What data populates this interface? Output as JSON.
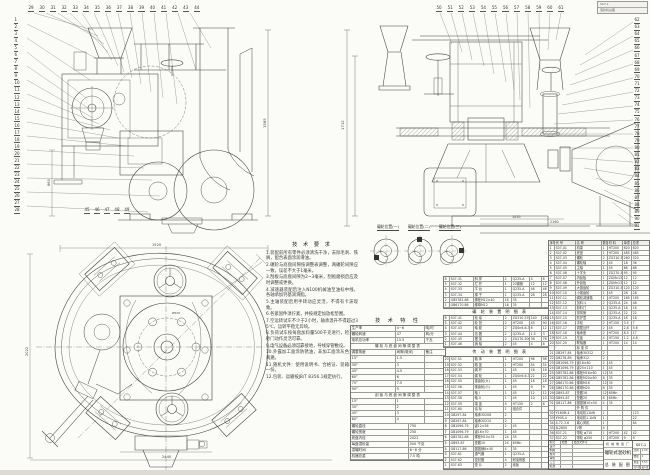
{
  "sheet": {
    "bg": "#fbfbf8",
    "line_color": "#3f3f3f",
    "strip_color": "#dcdbd6"
  },
  "stamp": {
    "line1": "S07-1",
    "line2": "混砂机总图"
  },
  "callouts": {
    "sv_left": [
      "1",
      "2",
      "3",
      "4",
      "5",
      "6",
      "7",
      "8",
      "9",
      "10",
      "11",
      "12",
      "13",
      "14",
      "15",
      "16",
      "17",
      "18",
      "19",
      "20",
      "21",
      "22",
      "23",
      "24",
      "25",
      "26",
      "27",
      "28"
    ],
    "sv_top": [
      "29",
      "30",
      "31",
      "32",
      "33",
      "34",
      "35",
      "36",
      "37",
      "38",
      "39",
      "40",
      "41",
      "42",
      "43",
      "44"
    ],
    "sv_bottom": [
      "45",
      "46",
      "47",
      "48",
      "49"
    ],
    "fv_top": [
      "50",
      "51",
      "52",
      "53",
      "54",
      "55",
      "56",
      "57",
      "58",
      "59",
      "60",
      "61"
    ],
    "fv_right": [
      "62",
      "63",
      "64",
      "65",
      "66",
      "67",
      "68",
      "69",
      "70",
      "71",
      "72",
      "73",
      "74",
      "75",
      "76",
      "77",
      "78",
      "79",
      "80",
      "81",
      "82",
      "83",
      "84",
      "85",
      "86",
      "87",
      "88",
      "89",
      "90",
      "91"
    ]
  },
  "dims": {
    "sv_h": "1585",
    "sv_w": "660",
    "fv_h": "1712",
    "fv_w1": "1035",
    "fv_w2": "2160",
    "pv_top": "1520",
    "pv_left": "2022",
    "pv_bottom": "2440",
    "pv_flange": "Ø520"
  },
  "detail_labels": [
    "碾轮位置(一)",
    "碾轮位置(二)",
    "碾轮位置(三)"
  ],
  "notes": {
    "title": "技 术 要 求",
    "items": [
      "1.装配前所有零件必须清洗干净，去除毛刺、铁屑，配合表面涂润滑油。",
      "2.碾轮与底盘间隙按调整表调整，两碾轮间隙应一致，误差不大于1毫米。",
      "3.刮板与底盘间隙为2~3毫米，刮板磨损后应及时调整或更换。",
      "4.减速器装配后注入N100机械油至油标中线，各轴承加钙基润滑脂。",
      "5.主轴装配后用手转动应灵活，不得有卡滞现象。",
      "6.各紧固件须拧紧，并按规定加放松垫圈。",
      "7.空运转试车不少于2小时，轴承温升不得超过35℃，运转平稳无异响。",
      "8.负荷试车按每盘加料量500千克进行，检查出砂门动作灵活可靠。",
      "9.电气设备必须可靠接地，导线穿管敷设。",
      "10.外露加工面涂防锈油，非加工面涂灰色油漆两遍。",
      "11.随机文件：使用说明书、合格证、装箱单各一份。",
      "12.包装、运输按JB/T 8356.1规定执行。"
    ]
  },
  "spec": {
    "title": "技 术 特 性",
    "top_rows": [
      [
        "生产率",
        "4~6",
        "吨/时"
      ],
      [
        "碾轮转速",
        "47",
        "转/分"
      ],
      [
        "电机总功率",
        "15.5",
        "千瓦"
      ]
    ],
    "h1": "碾轮与底盘间隙调整表",
    "g_head": [
      "调整角度",
      "间隙(毫米)",
      "备注"
    ],
    "g1_rows": [
      [
        "15°",
        "1.5",
        ""
      ],
      [
        "30°",
        "3",
        ""
      ],
      [
        "45°",
        "4.5",
        ""
      ],
      [
        "60°",
        "6",
        ""
      ],
      [
        "75°",
        "7.5",
        ""
      ],
      [
        "90°",
        "9",
        ""
      ]
    ],
    "h2": "刮板与底盘间隙调整表",
    "g2_rows": [
      [
        "15°",
        "1",
        ""
      ],
      [
        "30°",
        "2",
        ""
      ],
      [
        "45°",
        "3",
        ""
      ],
      [
        "60°",
        "4",
        ""
      ]
    ],
    "bottom_rows": [
      [
        "碾轮直径",
        "750"
      ],
      [
        "碾轮宽度",
        "250"
      ],
      [
        "底盘内径",
        "2022"
      ],
      [
        "每盘混砂量",
        "500 千克"
      ],
      [
        "混碾时间",
        "6~8 分"
      ],
      [
        "机器总重",
        "7.5 吨"
      ]
    ]
  },
  "subtables": {
    "a_rows": [
      [
        "6",
        "S07-31",
        "斜 撑",
        "2",
        "Q235-A",
        "4",
        "8"
      ],
      [
        "5",
        "S07-32",
        "栏 杆",
        "1",
        "20钢管",
        "12",
        "12"
      ],
      [
        "4",
        "S07-33",
        "平 台",
        "1",
        "Q235-A",
        "46",
        "46"
      ],
      [
        "3",
        "S07-34",
        "梯 子",
        "1",
        "Q235-A",
        "28",
        "28"
      ],
      [
        "2",
        "GB5782-86",
        "螺栓M12×40",
        "16",
        "35",
        "",
        ""
      ],
      [
        "1",
        "GB6170-86",
        "螺母M12",
        "16",
        "35",
        "",
        ""
      ]
    ],
    "b_title": "碾 轮 装 置 明 细 表",
    "b_rows": [
      [
        "6",
        "S07-41",
        "轮 缘",
        "2",
        "ZG310-570",
        "140",
        "280"
      ],
      [
        "5",
        "S07-42",
        "轮 毂",
        "2",
        "HT200",
        "45",
        "90"
      ],
      [
        "4",
        "S07-43",
        "轴 套",
        "2",
        "ZQSn6-6-3",
        "6",
        "12"
      ],
      [
        "3",
        "S07-44",
        "挡 圈",
        "2",
        "Q235-A",
        "1.5",
        "3"
      ],
      [
        "2",
        "S07-45",
        "摆 架",
        "2",
        "ZG270-500",
        "38",
        "76"
      ],
      [
        "1",
        "S07-46",
        "销 轴",
        "2",
        "45",
        "4",
        "8"
      ]
    ],
    "c_title": "传 动 装 置 明 细 表",
    "c_rows": [
      [
        "20",
        "S07-51",
        "箱 体",
        "1",
        "HT200",
        "96",
        "96"
      ],
      [
        "19",
        "S07-52",
        "箱 盖",
        "1",
        "HT200",
        "54",
        "54"
      ],
      [
        "18",
        "S07-53",
        "蜗 杆",
        "1",
        "45",
        "16",
        "16"
      ],
      [
        "17",
        "S07-54",
        "蜗 轮",
        "1",
        "ZQSn6-6-3",
        "22",
        "22"
      ],
      [
        "16",
        "S07-55",
        "锥齿轮(大)",
        "1",
        "45",
        "18",
        "18"
      ],
      [
        "15",
        "S07-56",
        "锥齿轮(小)",
        "1",
        "45",
        "9",
        "9"
      ],
      [
        "14",
        "S07-57",
        "轴 I",
        "1",
        "45",
        "12",
        "12"
      ],
      [
        "13",
        "S07-58",
        "轴 II",
        "1",
        "45",
        "10",
        "10"
      ],
      [
        "12",
        "S07-59",
        "端 盖",
        "4",
        "HT150",
        "2",
        "8"
      ],
      [
        "11",
        "S07-60",
        "油 标",
        "1",
        "组合件",
        "",
        ""
      ],
      [
        "10",
        "GB297-84",
        "轴承30208",
        "2",
        "",
        "",
        ""
      ],
      [
        "9",
        "GB297-84",
        "轴承30210",
        "2",
        "",
        "",
        ""
      ],
      [
        "8",
        "GB1096-79",
        "键12×56",
        "2",
        "45",
        "",
        ""
      ],
      [
        "7",
        "GB1096-79",
        "键16×70",
        "1",
        "45",
        "",
        ""
      ],
      [
        "6",
        "GB5782-86",
        "螺栓M10×35",
        "24",
        "35",
        "",
        ""
      ],
      [
        "5",
        "GB93-87",
        "垫圈10",
        "24",
        "65Mn",
        "",
        ""
      ],
      [
        "4",
        "GB117-86",
        "圆锥销8×40",
        "4",
        "35",
        "",
        ""
      ],
      [
        "3",
        "S07-61",
        "通气器",
        "1",
        "Q235-A",
        "",
        ""
      ],
      [
        "2",
        "S07-62",
        "密封圈",
        "4",
        "耐油橡胶",
        "",
        ""
      ],
      [
        "1",
        "S07-63",
        "垫 片",
        "2",
        "纸板",
        "",
        ""
      ]
    ]
  },
  "bom": {
    "header": [
      "序号",
      "代 号",
      "名 称",
      "数量",
      "材 料",
      "单重",
      "总重"
    ],
    "rows": [
      [
        "1",
        "S07-01",
        "机架",
        "1",
        "HT200",
        "620",
        "620"
      ],
      [
        "2",
        "S07-02",
        "底盘",
        "1",
        "HT200",
        "485",
        "485"
      ],
      [
        "3",
        "S07-03",
        "碾轮",
        "2",
        "ZG310-570",
        "260",
        "520"
      ],
      [
        "4",
        "S07-04",
        "碾轮轴",
        "2",
        "45",
        "18",
        "36"
      ],
      [
        "5",
        "S07-05",
        "主轴",
        "1",
        "45",
        "86",
        "86"
      ],
      [
        "6",
        "S07-06",
        "十字头",
        "1",
        "ZG270-500",
        "95",
        "95"
      ],
      [
        "7",
        "S07-07",
        "内刮板",
        "1",
        "ZGMn13",
        "12",
        "12"
      ],
      [
        "8",
        "S07-08",
        "外刮板",
        "1",
        "ZGMn13",
        "12",
        "12"
      ],
      [
        "9",
        "S07-09",
        "大锥齿轮",
        "1",
        "ZG310-570",
        "120",
        "120"
      ],
      [
        "10",
        "S07-10",
        "小锥齿轮",
        "1",
        "45",
        "28",
        "28"
      ],
      [
        "11",
        "S07-11",
        "蜗轮减速箱",
        "1",
        "HT200",
        "165",
        "165"
      ],
      [
        "12",
        "S07-12",
        "加料斗",
        "2",
        "Q235-A",
        "24",
        "48"
      ],
      [
        "13",
        "S07-13",
        "卸料门",
        "1",
        "Q235-A",
        "16",
        "16"
      ],
      [
        "14",
        "S07-14",
        "排风管",
        "1",
        "Q235-A",
        "22",
        "22"
      ],
      [
        "15",
        "S07-15",
        "防护罩",
        "1",
        "Q235-A",
        "18",
        "18"
      ],
      [
        "16",
        "S07-16",
        "手轮",
        "2",
        "HT150",
        "3.5",
        "7"
      ],
      [
        "17",
        "S07-17",
        "调整丝杆",
        "2",
        "45",
        "2.8",
        "5.6"
      ],
      [
        "18",
        "S07-18",
        "轴承座",
        "2",
        "HT200",
        "8.5",
        "17"
      ],
      [
        "19",
        "S07-19",
        "压盖",
        "4",
        "HT150",
        "1.2",
        "4.8"
      ],
      [
        "20",
        "S07-20",
        "联轴器",
        "1",
        "HT200",
        "14",
        "14"
      ],
      [
        "",
        "",
        "标 准 件",
        "",
        "",
        "",
        ""
      ],
      [
        "21",
        "GB297-84",
        "轴承30312",
        "2",
        "",
        "",
        ""
      ],
      [
        "22",
        "GB276-89",
        "轴承312",
        "2",
        "",
        "",
        ""
      ],
      [
        "23",
        "GB1096-79",
        "键18×80",
        "2",
        "45",
        "",
        ""
      ],
      [
        "24",
        "GB1096-79",
        "键25×110",
        "1",
        "45",
        "",
        ""
      ],
      [
        "25",
        "GB5782-86",
        "螺栓M16×60",
        "12",
        "35",
        "",
        ""
      ],
      [
        "26",
        "GB5782-86",
        "螺栓M20×80",
        "8",
        "35",
        "",
        ""
      ],
      [
        "27",
        "GB6170-86",
        "螺母M16",
        "12",
        "35",
        "",
        ""
      ],
      [
        "28",
        "GB6170-86",
        "螺母M20",
        "8",
        "35",
        "",
        ""
      ],
      [
        "29",
        "GB93-87",
        "垫圈16",
        "12",
        "65Mn",
        "",
        ""
      ],
      [
        "30",
        "GB93-87",
        "垫圈20",
        "8",
        "65Mn",
        "",
        ""
      ],
      [
        "31",
        "GB117-86",
        "圆锥销10×50",
        "4",
        "35",
        "",
        ""
      ],
      [
        "",
        "",
        "外 购 件",
        "",
        "",
        "",
        ""
      ],
      [
        "32",
        "Y160M-4",
        "电动机11kW",
        "1",
        "",
        "",
        "123"
      ],
      [
        "33",
        "Y90S-4",
        "电动机1.1kW",
        "1",
        "",
        "",
        "22"
      ],
      [
        "34",
        "4-72-3.6",
        "离心风机",
        "1",
        "",
        "",
        "64"
      ],
      [
        "35",
        "B-2800",
        "V带",
        "4",
        "",
        "",
        ""
      ],
      [
        "36",
        "S07-21",
        "带轮 φ710",
        "1",
        "HT200",
        "42",
        "42"
      ],
      [
        "37",
        "S07-22",
        "带轮 φ250",
        "1",
        "HT200",
        "9",
        "9"
      ]
    ]
  },
  "title_block": {
    "left_rows": [
      [
        "标记",
        "处数",
        "更改文件号"
      ],
      [
        "设计",
        "",
        ""
      ],
      [
        "制图",
        "",
        ""
      ],
      [
        "校对",
        "",
        ""
      ],
      [
        "审核",
        "",
        ""
      ],
      [
        "工艺",
        "",
        ""
      ],
      [
        "批准",
        "",
        ""
      ]
    ],
    "factory": "机 械 制 造 厂",
    "title": "碾轮式混砂机",
    "subtitle": "总 装 配 图",
    "code": "S07-1",
    "right_rows": [
      [
        "比例",
        "1:10"
      ],
      [
        "数量",
        "1"
      ],
      [
        "重量",
        "7.5 t"
      ],
      [
        "共1张",
        "第1张"
      ]
    ]
  }
}
